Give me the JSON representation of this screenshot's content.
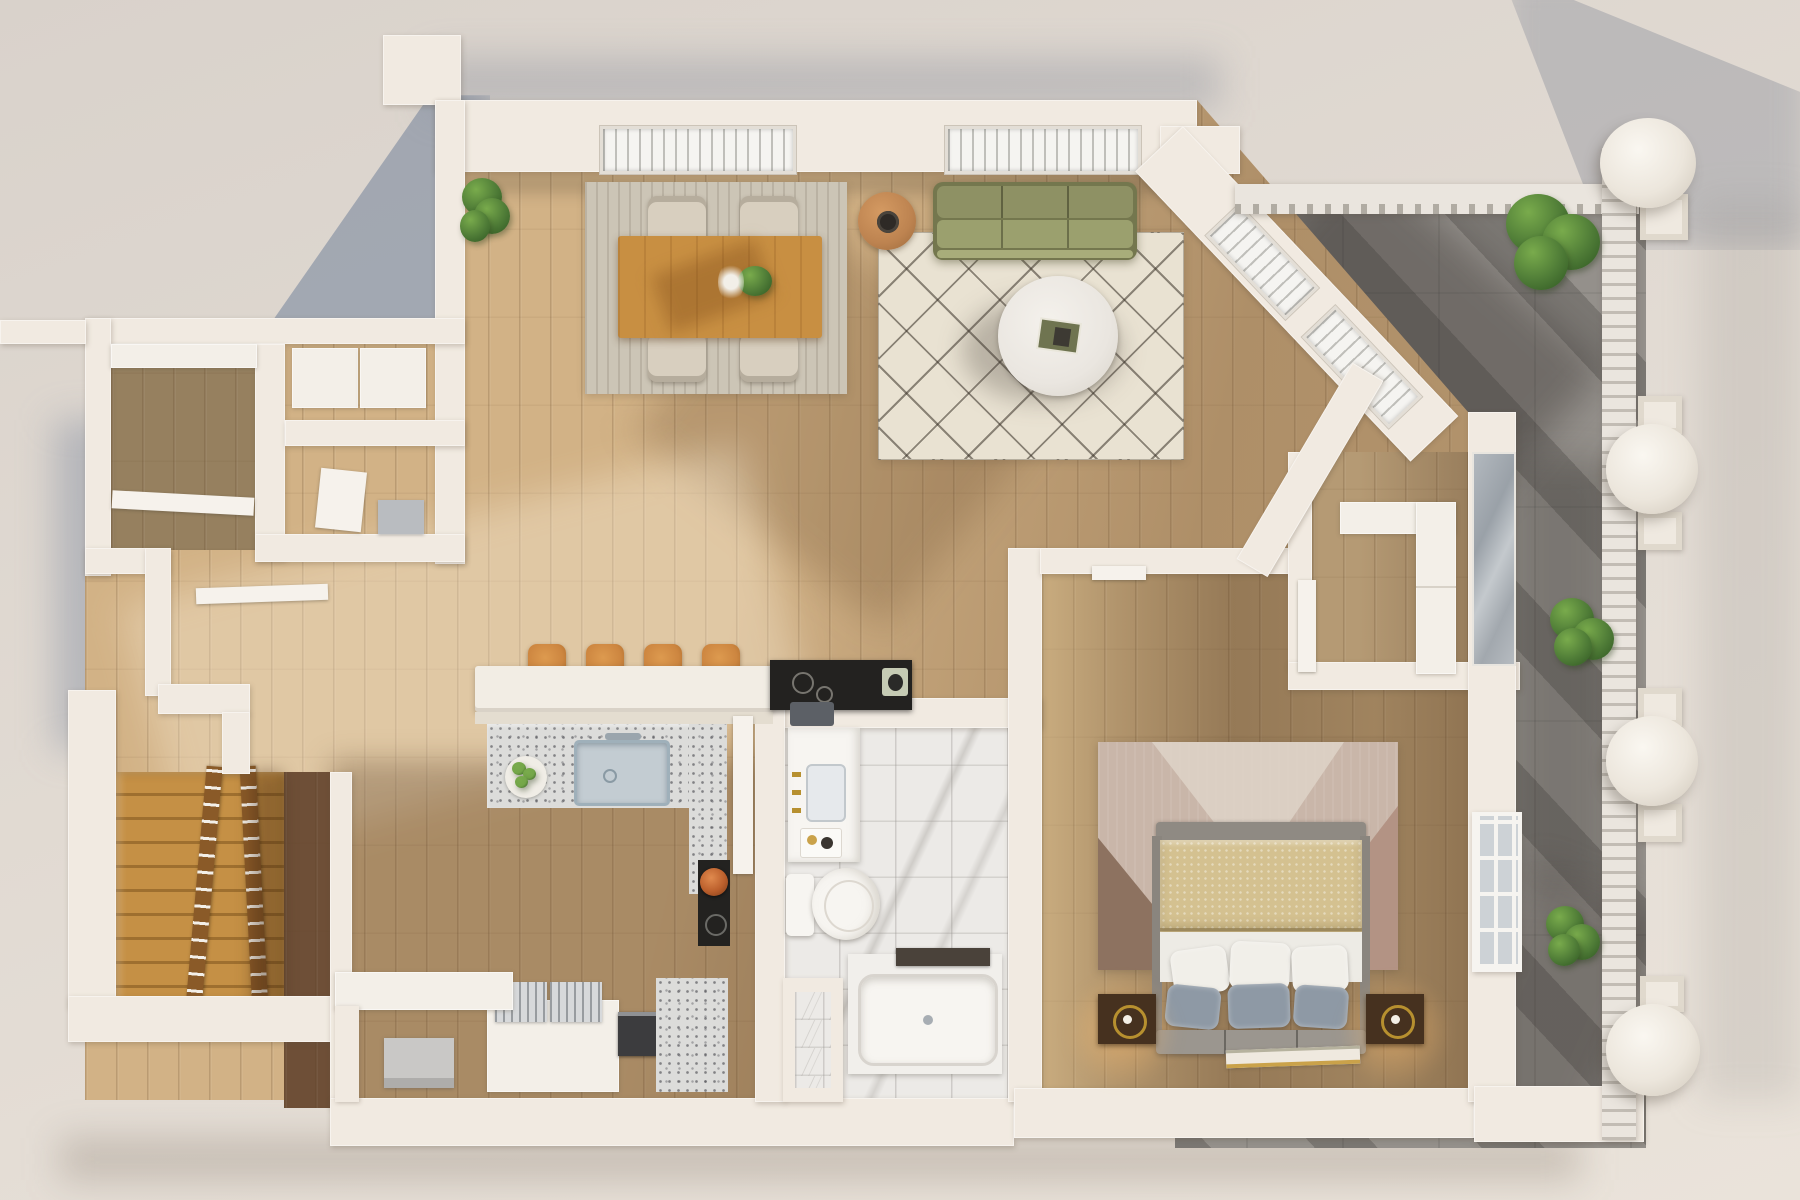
{
  "scene": {
    "kind": "3d-top-down-apartment-floor-plan-render",
    "areas": [
      "living-room",
      "dining-area",
      "kitchen",
      "island-bar",
      "bathroom",
      "bedroom",
      "closet-nook",
      "entry-closets",
      "staircase",
      "laundry-nook",
      "balcony-terrace"
    ],
    "furniture": [
      "olive-sofa",
      "diamond-pattern-rug",
      "round-coffee-table",
      "round-side-table",
      "dining-table",
      "dining-chairs",
      "potted-plants",
      "bar-stools",
      "kitchen-island",
      "kitchen-sink",
      "black-cooktop",
      "copper-pot",
      "fruit-bowl",
      "dish-racks",
      "coffee-machine",
      "vanity",
      "toilet",
      "shower-stall",
      "bathtub",
      "double-bed",
      "pillows",
      "nightstands",
      "bedroom-rug",
      "books",
      "wardrobe-unit",
      "glass-partition",
      "wooden-staircase",
      "stair-railings",
      "balcony-columns",
      "balcony-railing"
    ]
  },
  "palette": {
    "bg_top": "#d9d2cb",
    "bg_bottom": "#e4ddd5",
    "shadow_blue": "#7d88a0",
    "wall": "#f1eae1",
    "wall_dark": "#ddd4c8",
    "wood_light": "#d2b286",
    "wood_mid": "#c3a174",
    "wood_dark": "#9c805c",
    "wood_deep": "#6e4f37",
    "wood_bed": "#b1946c",
    "stairs_light": "#c59045",
    "stairs_dark": "#9e6f2f",
    "terrace": "#94908b",
    "terrace_shadow": "#5e5a56",
    "railing": "#eae5de",
    "rug_living": "#e9e2d2",
    "rug_dining": "#ccc5b6",
    "sofa": "#8e9164",
    "sofa_light": "#9ba06e",
    "sofa_dark": "#74774e",
    "coffee_table": "#eae6e0",
    "side_table": "#bd8350",
    "bowl_dark": "#2e2a26",
    "dining_table": "#c88f42",
    "chair": "#d8cfbf",
    "island_counter": "#f2ede4",
    "counter_tier": "#e4ddd0",
    "terrazzo": "#dcdcda",
    "sink_metal": "#c3ccd2",
    "stool": "#cd8640",
    "counter_black": "#232220",
    "copper": "#bb5f2c",
    "board_green": "#c5cbb4",
    "marble": "#eceae7",
    "gold": "#b7902f",
    "fixture_white": "#f7f5f1",
    "towel_dark": "#5c6066",
    "rug_bed_base": "#c9b6a9",
    "rug_bed_dark": "#8d7260",
    "rug_bed_mid": "#b39384",
    "rug_bed_pale": "#ded3c8",
    "duvet": "#d4c190",
    "sheet": "#edebe5",
    "pillow_white": "#f1efe9",
    "pillow_blue": "#8e99a5",
    "bench": "#9b968f",
    "nightstand": "#46311f",
    "plant_dark": "#2f5722",
    "plant_mid": "#4f7c37",
    "plant_light": "#79ab4c",
    "door_white": "#f6f2ec",
    "glass_gray": "#a9aeb3",
    "rack_metal": "#d7d9db",
    "machine_dark": "#3c3c3e",
    "box_gray": "#c9c8c6"
  }
}
